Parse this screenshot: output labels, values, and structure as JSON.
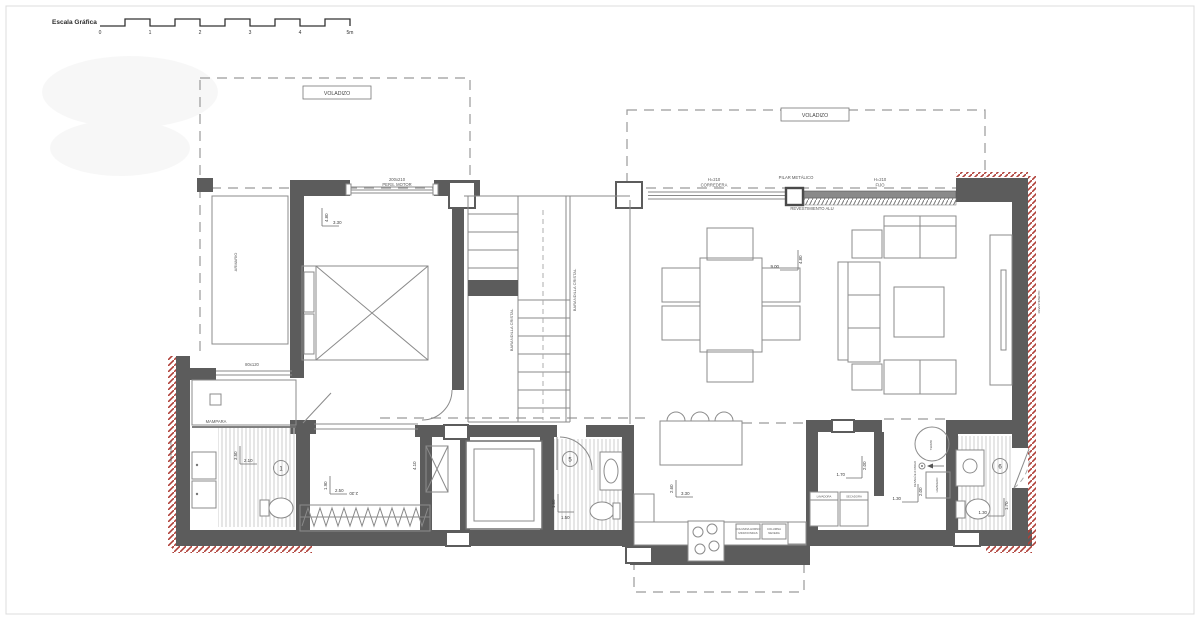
{
  "scale_bar": {
    "label": "Escala Gráfica",
    "ticks": [
      "0",
      "1",
      "2",
      "3",
      "4",
      "5m"
    ]
  },
  "labels": {
    "voladizo": "VOLADIZO",
    "window_bedroom_size": "200x210",
    "window_bedroom_type": "PERS. MOTOR",
    "window_sliding_h": "H=210",
    "window_sliding_type": "CORREDERA",
    "pilar_metalico": "PILAR METÁLICO",
    "window_fixed_h": "H=210",
    "window_fixed_type": "FIJO",
    "revestimiento_alu": "REVESTIMIENTO ALU",
    "armario": "ARMARIO",
    "barandilla": "BARANDILLA CRISTAL",
    "mampara": "MAMPARA",
    "bath_window_size": "80x120",
    "revestimiento": "REVESTIMIENTO",
    "desague": "DESAGÜE A PARED",
    "termo": "TERMO",
    "lavadero": "LAVADERO",
    "lavadora": "LAVADORA",
    "secadora": "SECADORA",
    "columna_horno_1": "COLUMNA HORNO",
    "columna_horno_2": "MICROONDAS",
    "columna_nevera_1": "COLUMNA",
    "columna_nevera_2": "NEVERA"
  },
  "dimensions": {
    "bedroom_w": "3.30",
    "bedroom_h": "4.80",
    "living_w": "9.00",
    "living_h": "4.80",
    "bath_main_w": "2.10",
    "bath_main_h": "3.50",
    "dressing_w": "2.50",
    "dressing_h": "1.90",
    "dressing_alt": "2.30",
    "hall_h": "4.10",
    "bath_guest_w": "1.50",
    "bath_guest_h": "1.50",
    "kitchen_w": "3.30",
    "kitchen_h": "2.60",
    "laundry_w": "1.70",
    "laundry_h": "2.00",
    "utility_w": "1.30",
    "utility_h": "2.00",
    "bath_right_w": "1.30",
    "bath_right_h": "1.70"
  },
  "tags": {
    "bath_main": "1",
    "bath_guest": "5",
    "bath_right": "6"
  },
  "colors": {
    "wall": "#5c5c5c",
    "thin_line": "#8a8a8a",
    "red_hatch": "#b04038",
    "background": "#ffffff"
  }
}
